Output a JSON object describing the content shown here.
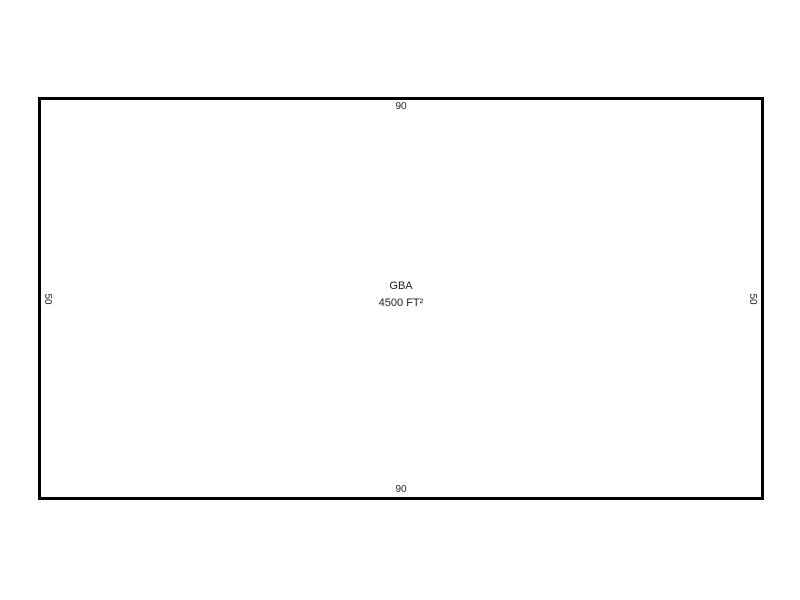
{
  "sketch": {
    "type": "floor-plan-outline",
    "area_label": "GBA",
    "area_value": "4500 FT²",
    "dimensions": {
      "top": "90",
      "bottom": "90",
      "left": "50",
      "right": "50"
    },
    "colors": {
      "outline": "#000000",
      "background": "#ffffff",
      "text": "#1f1f1f"
    }
  }
}
